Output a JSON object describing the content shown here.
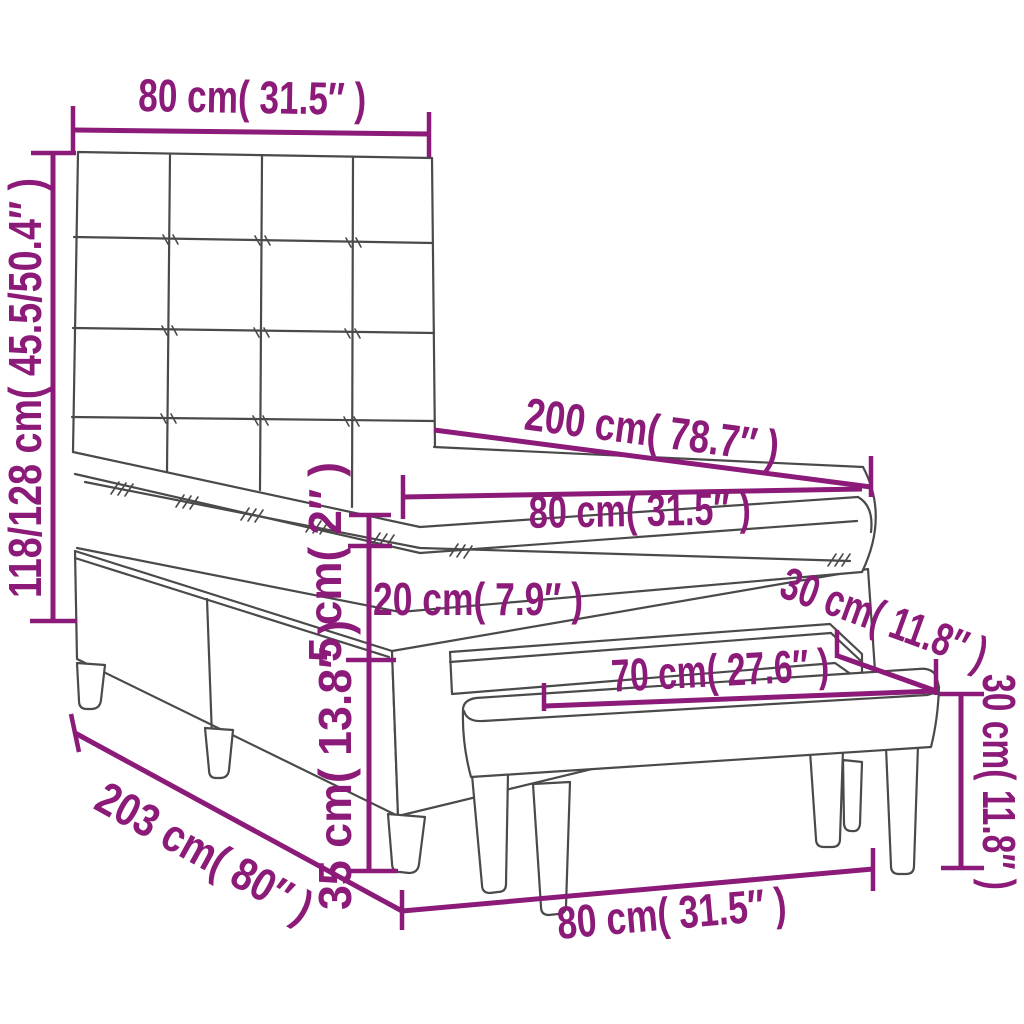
{
  "figure": {
    "type": "product-dimension-diagram",
    "subject": "box spring bed with tufted headboard, mattress, topper and bench",
    "accent_color": "#8B1A78",
    "line_color": "#4A4A4A",
    "background_color": "#FFFFFF"
  },
  "dimensions": {
    "headboard_width": "80 cm( 31.5″ )",
    "bed_height": "118/128 cm( 45.5/50.4″ )",
    "mattress_length": "200 cm( 78.7″ )",
    "mattress_width": "80 cm( 31.5″ )",
    "topper_thickness": "5 cm( 2″ )",
    "mattress_thickness": "20 cm( 7.9″ )",
    "base_height": "35 cm( 13.8″ )",
    "bed_length": "203 cm( 80″ )",
    "overall_width": "80 cm( 31.5″ )",
    "bench_seat_length": "70 cm( 27.6″ )",
    "bench_depth": "30 cm( 11.8″ )",
    "bench_height": "30 cm( 11.8″ )"
  }
}
